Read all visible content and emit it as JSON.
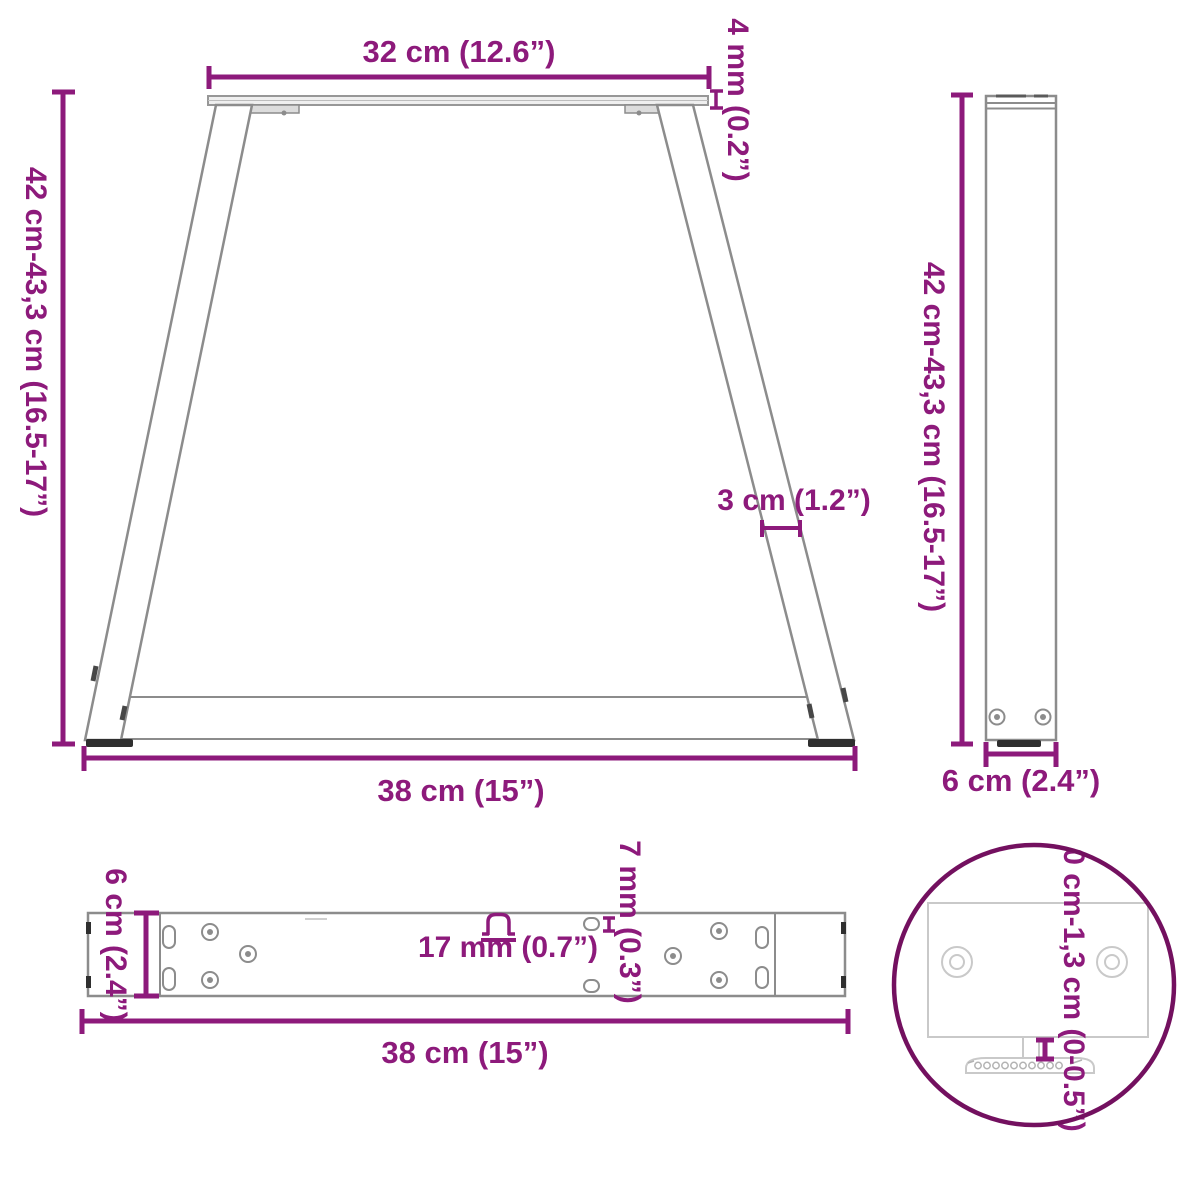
{
  "colors": {
    "accent": "#8d1a7b",
    "ring": "#73105f",
    "outline": "#8c8c8c",
    "detail_outline": "#c9c9c9",
    "part_dark": "#2f2f2f"
  },
  "views": {
    "front": {
      "dim_top_width": "32 cm (12.6”)",
      "dim_plate_thickness": "4 mm (0.2”)",
      "dim_height": "42 cm-43,3 cm (16.5-17”)",
      "dim_leg_width": "3 cm (1.2”)",
      "dim_bottom_width": "38 cm (15”)"
    },
    "side": {
      "dim_height": "42 cm-43,3 cm (16.5-17”)",
      "dim_depth": "6 cm (2.4”)"
    },
    "top": {
      "dim_depth": "6 cm (2.4”)",
      "dim_length": "38 cm (15”)",
      "dim_slot_length": "17 mm (0.7”)",
      "dim_slot_width": "7 mm (0.3”)"
    },
    "detail": {
      "dim_foot_adjustment": "0 cm-1,3 cm (0-0.5”)"
    }
  }
}
